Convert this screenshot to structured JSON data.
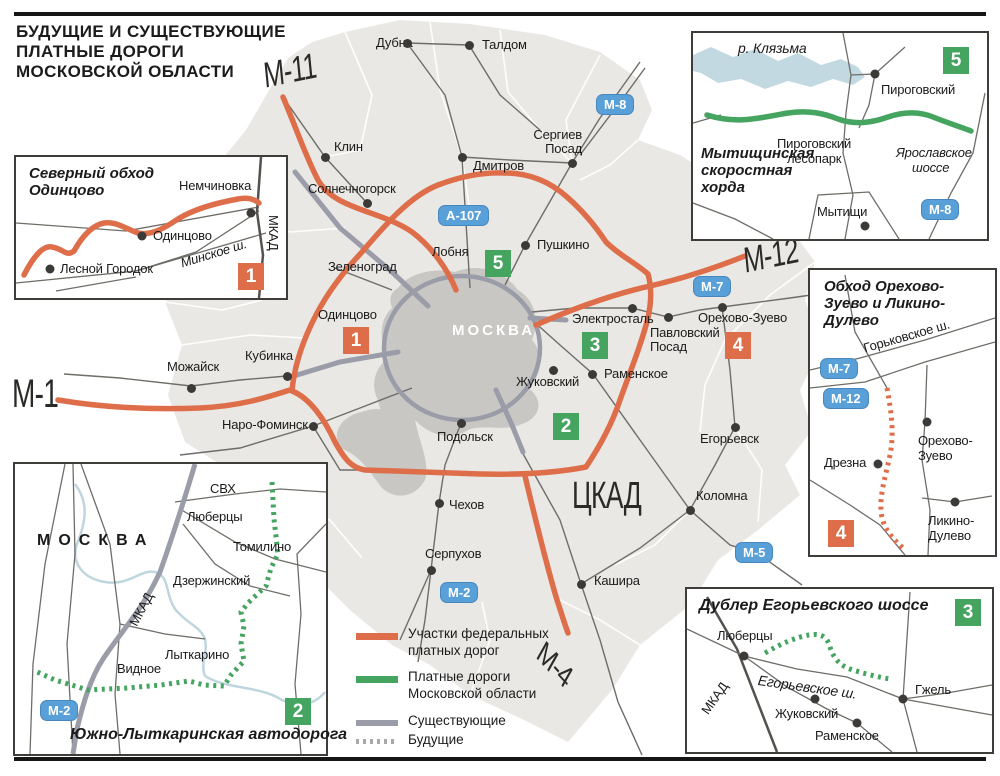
{
  "title": {
    "line1": "БУДУЩИЕ И СУЩЕСТВУЮЩИЕ",
    "line2": "ПЛАТНЫЕ ДОРОГИ",
    "line3": "МОСКОВСКОЙ ОБЛАСТИ"
  },
  "colors": {
    "federal_toll": "#DE6E4A",
    "regional_toll": "#45A45F",
    "road_pill_blue": "#58A0D7",
    "existing_gray": "#9A9CA8",
    "future_dash_gray": "#A8A8A8"
  },
  "legend": {
    "federal_line1": "Участки федеральных",
    "federal_line2": "платных дорог",
    "regional_line1": "Платные дороги",
    "regional_line2": "Московской области",
    "existing": "Существующие",
    "future": "Будущие"
  },
  "main_map": {
    "moscow": "МОСКВА",
    "cities": {
      "dubna": "Дубна",
      "taldom": "Талдом",
      "klin": "Клин",
      "solnechnogorsk": "Солнечногорск",
      "dmitrov": "Дмитров",
      "sergiev_posad": "Сергиев Посад",
      "pushkino": "Пушкино",
      "lobnya": "Лобня",
      "zelenograd": "Зеленоград",
      "odintsovo": "Одинцово",
      "elektrostal": "Электросталь",
      "pavlovsky_posad": "Павловский Посад",
      "orekhovo_zuevo": "Орехово-Зуево",
      "ramenskoye": "Раменское",
      "zhukovsky": "Жуковский",
      "mozhaysk": "Можайск",
      "kubinka": "Кубинка",
      "naro_fominsk": "Наро-Фоминск",
      "podolsk": "Подольск",
      "chekhov": "Чехов",
      "serpukhov": "Серпухов",
      "kashira": "Кашира",
      "kolomna": "Коломна",
      "egoryevsk": "Егорьевск"
    },
    "highways": {
      "m11": "М-11",
      "m1": "М-1",
      "m12": "М-12",
      "m4": "М-4",
      "ckad": "ЦКАД"
    },
    "pills": {
      "m8": "М-8",
      "a107": "А-107",
      "m7": "М-7",
      "m2": "М-2",
      "m5": "М-5"
    },
    "badges": {
      "n1": "1",
      "n2": "2",
      "n3": "3",
      "n4": "4",
      "n5": "5"
    }
  },
  "insets": {
    "odintsovo": {
      "title_line1": "Северный обход",
      "title_line2": "Одинцово",
      "badge": "1",
      "labels": {
        "nemchinovka": "Немчиновка",
        "odintsovo": "Одинцово",
        "lesnoy": "Лесной Городок",
        "minskoe": "Минское ш.",
        "mkad": "МКАД"
      }
    },
    "mytishchi": {
      "title_line1": "Мытищинская",
      "title_line2": "скоростная",
      "title_line3": "хорда",
      "badge": "5",
      "labels": {
        "klyazma": "р. Клязьма",
        "pirogovskiy": "Пироговский",
        "lesopark_line1": "Пироговский",
        "lesopark_line2": "лесопарк",
        "yaroslav_line1": "Ярославское",
        "yaroslav_line2": "шоссе",
        "mytishchi": "Мытищи",
        "m8": "М-8"
      }
    },
    "orekhovo": {
      "title_line1": "Обход Орехово-",
      "title_line2": "Зуево и Ликино-",
      "title_line3": "Дулево",
      "badge": "4",
      "labels": {
        "gorkovskoe": "Горьковское ш.",
        "m7": "М-7",
        "m12": "М-12",
        "drezna": "Дрезна",
        "oz_line1": "Орехово-",
        "oz_line2": "Зуево",
        "ld_line1": "Ликино-",
        "ld_line2": "Дулево"
      }
    },
    "egoryevsk": {
      "title": "Дублер Егорьевского шоссе",
      "badge": "3",
      "labels": {
        "lyubertsy": "Люберцы",
        "mkad": "МКАД",
        "egoryevskoe": "Егорьевское ш.",
        "gzhel": "Гжель",
        "zhukovsky": "Жуковский",
        "ramenskoye": "Раменское"
      }
    },
    "lytkarino": {
      "title": "Южно-Лыткаринская автодорога",
      "badge": "2",
      "labels": {
        "moscow": "МОСКВА",
        "svh": "СВХ",
        "lyubertsy": "Люберцы",
        "tomilino": "Томилино",
        "dzerzhinsky": "Дзержинский",
        "mkad": "МКАД",
        "lytkarino": "Лыткарино",
        "vidnoe": "Видное",
        "m2": "М-2"
      }
    }
  }
}
